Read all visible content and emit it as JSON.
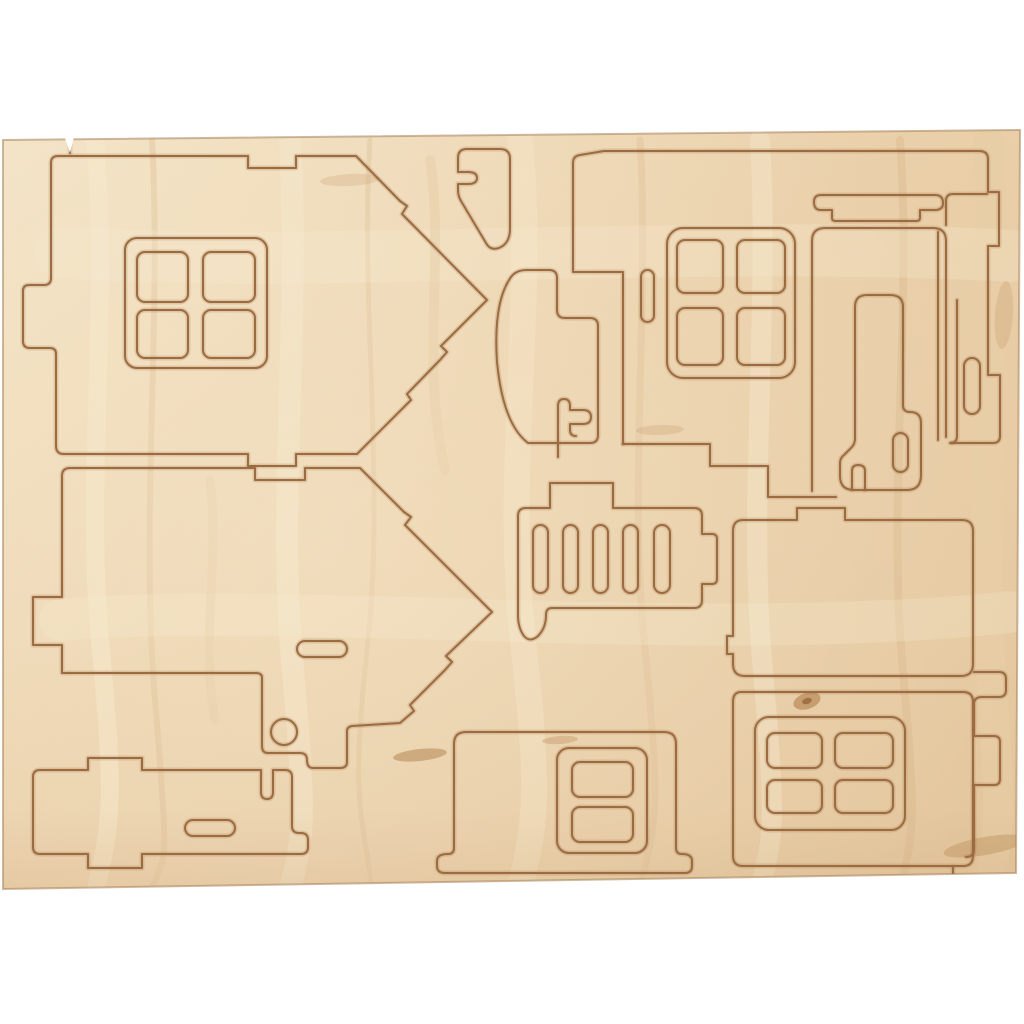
{
  "meta": {
    "description": "Photograph of a light birch plywood sheet with laser-cut press-out pieces for a 3D wooden house kit: two pointed gable walls with a four-pane window, wall panels with four-pane and two-pane windows, a door with frame and lintel, an arch, a chimney, a slotted railing piece and base plates, on a white background"
  },
  "colors": {
    "background": "#ffffff",
    "wood_light": "#f3e3c6",
    "wood_base": "#ead0aa",
    "wood_mid": "#e3c59c",
    "wood_dark": "#d9b88e",
    "grain_light": "#f6e8cc",
    "grain_dark": "#d2ab7e",
    "knot": "#a9773f",
    "cut": "#9c6b40",
    "cut_halo": "rgba(156,107,64,0.22)",
    "sheet_edge": "rgba(168,128,86,0.55)",
    "bottom_shade": "rgba(176,136,94,0.28)"
  },
  "sheet": {
    "outline": "M3,140 L1020,130 L1016,873 L3,889 Z",
    "notches": [
      "M65,138 L74,137 L70,153 Z"
    ]
  },
  "pieces": [
    {
      "name": "gable-wall-upper-left",
      "cuts": [
        {
          "d": "M58,156 H248 V168 H296 V156 H356 L400,201 L407,206 L402,214 L487,300 L441,346 L447,352 L440,360 L407,394 L411,400 L404,407 L357,454 H296 V466 H248 V454 H64 Q56,454 56,446 V354 Q56,348 50,348 H30 Q23,348 23,341 V291 Q23,285 29,285 H44 Q51,285 51,278 V163 Q51,156 58,156 Z"
        },
        {
          "rrect": [
            125,
            238,
            142,
            130,
            12
          ]
        },
        {
          "rrect": [
            137,
            252,
            51,
            50,
            8
          ]
        },
        {
          "rrect": [
            203,
            252,
            52,
            50,
            8
          ]
        },
        {
          "rrect": [
            137,
            310,
            51,
            48,
            8
          ]
        },
        {
          "rrect": [
            203,
            310,
            52,
            48,
            8
          ]
        }
      ]
    },
    {
      "name": "gable-wall-lower-left",
      "cuts": [
        {
          "d": "M70,468 H255 V480 H305 V468 H360 L404,512 L411,517 L405,525 L492,612 L446,656 L452,662 L445,670 L410,705 L414,711 L400,723 L352,726 Q347,727 347,731 V762 Q347,768 340,768 H313 Q307,768 307,760 Q307,753 300,753 H268 Q262,753 262,746 V678 Q262,673 256,673 H62 V645 H33 V597 H62 V476 Q62,468 70,468 Z"
        },
        {
          "rrect": [
            297,
            641,
            50,
            16,
            8
          ]
        },
        {
          "rrect": [
            271,
            719,
            26,
            26,
            13
          ]
        }
      ]
    },
    {
      "name": "base-plate-left",
      "cuts": [
        {
          "d": "M40,770 H88 V758 H142 V770 H261 V792 Q261,799 267,799 Q273,799 273,792 V770 H285 Q292,770 292,777 V826 Q292,833 299,833 H301 Q308,833 308,840 V847 Q308,854 301,854 H142 V868 H88 V854 H40 Q33,854 33,847 V777 Q33,770 40,770 Z"
        },
        {
          "rrect": [
            185,
            820,
            50,
            16,
            8
          ]
        }
      ]
    },
    {
      "name": "chimney-top-center",
      "cuts": [
        {
          "d": "M467,149 Q458,149 458,158 V172 H468 Q477,172 477,178 Q477,184 468,184 H458 V190 Q458,196 461,201 L486,243 Q491,252 501,247 Q510,242 510,229 V159 Q510,149 500,149 Z"
        }
      ]
    },
    {
      "name": "arch-center",
      "cuts": [
        {
          "d": "M527,270 H549 Q557,270 557,278 V310 Q557,318 565,318 H590 Q598,318 598,326 V435 Q598,443 590,443 H528 Q503,424 497,362 Q493,302 511,277 Q516,270 527,270 Z"
        },
        {
          "d": "M558,457 V406 Q558,399 564,399 Q570,399 570,406 V410 H583 Q591,410 591,417 Q591,424 583,424 H570 V430 Q570,436 576,436"
        }
      ]
    },
    {
      "name": "railing-fence-center",
      "cuts": [
        {
          "d": "M526,508 H550 V483 H613 V508 H694 Q702,508 702,516 V534 H712 Q717,534 717,539 V579 Q717,584 712,584 H702 V600 Q702,608 694,608 H552 Q546,608 546,615 Q546,628 538,636 Q530,643 524,636 Q518,628 518,615 V516 Q518,508 526,508 Z"
        },
        {
          "rrect": [
            533,
            525,
            15,
            68,
            7.5
          ]
        },
        {
          "rrect": [
            563,
            525,
            15,
            68,
            7.5
          ]
        },
        {
          "rrect": [
            593,
            525,
            15,
            68,
            7.5
          ]
        },
        {
          "rrect": [
            623,
            525,
            15,
            68,
            7.5
          ]
        },
        {
          "rrect": [
            654,
            525,
            16,
            68,
            8
          ]
        }
      ]
    },
    {
      "name": "front-wall-upper-right",
      "cuts": [
        {
          "d": "M623,444 V272 H573 V163 Q573,156 580,155 L604,151 H979 Q988,151 988,159 V192 H999 V246 H988 V375 H1000 V436 Q1000,443 993,443 H952"
        },
        {
          "d": "M623,444 H710 V466 H768 V497 H836"
        },
        {
          "rrect": [
            667,
            228,
            128,
            150,
            16
          ]
        },
        {
          "rrect": [
            677,
            240,
            46,
            53,
            8
          ]
        },
        {
          "rrect": [
            737,
            240,
            48,
            53,
            8
          ]
        },
        {
          "rrect": [
            677,
            308,
            46,
            57,
            8
          ]
        },
        {
          "rrect": [
            737,
            308,
            48,
            57,
            8
          ]
        },
        {
          "rrect": [
            641,
            270,
            13,
            52,
            6.5
          ]
        }
      ]
    },
    {
      "name": "door-lintel",
      "cuts": [
        {
          "d": "M821,195 H935 Q943,195 943,203 Q943,210 935,210 H920 V218 Q920,221 916,221 H836 Q832,221 832,218 V210 H821 Q814,210 814,202 Q814,195 821,195 Z"
        }
      ]
    },
    {
      "name": "door-and-frame",
      "cuts": [
        {
          "d": "M812,491 V241 Q812,228 825,228 H933 Q946,228 946,241 V437"
        },
        {
          "d": "M867,295 H890 Q903,295 903,307 V405 Q903,412 910,412 Q921,412 921,423 V475 Q921,490 907,490 H854 Q840,490 840,476 V463 Q840,458 844,455 L851,448 Q855,444 855,439 V307 Q855,295 867,295 Z"
        },
        {
          "rrect": [
            893,
            433,
            15,
            39,
            7.5
          ]
        },
        {
          "d": "M852,490 V471 Q852,465 858,465 Q865,465 865,471 V490"
        },
        {
          "d": "M938,232 V440"
        },
        {
          "d": "M957,300 V436 Q957,443 950,443"
        },
        {
          "rrect": [
            964,
            358,
            16,
            56,
            8
          ]
        },
        {
          "d": "M946,225 V201 Q946,194 953,194 H987"
        }
      ]
    },
    {
      "name": "roof-panel-right",
      "cuts": [
        {
          "d": "M743,520 H797 V508 H845 V520 H962 Q973,520 973,531 V664 Q973,676 961,676 H745 Q733,676 733,664 V654 H727 V636 H733 V531 Q733,520 743,520 Z"
        }
      ]
    },
    {
      "name": "side-strip-right",
      "cuts": [
        {
          "d": "M974,672 H999 Q1006,672 1006,679 V690 Q1006,697 999,697 H982 Q974,697 974,704 V736 H994 Q1000,736 1000,742 V779 Q1000,785 994,785 H974 V849 Q974,857 966,857"
        }
      ]
    },
    {
      "name": "window-wall-bottom-center",
      "cuts": [
        {
          "d": "M466,732 Q454,732 454,744 V848 Q454,854 448,854 Q437,854 437,861 V866 Q437,873 445,873 H685 Q692,873 692,866 V861 Q692,854 682,854 Q676,854 676,848 V744 Q676,732 664,732 Z"
        },
        {
          "rrect": [
            557,
            748,
            90,
            105,
            12
          ]
        },
        {
          "rrect": [
            572,
            762,
            61,
            35,
            8
          ]
        },
        {
          "rrect": [
            572,
            807,
            61,
            35,
            8
          ]
        }
      ]
    },
    {
      "name": "window-wall-bottom-right",
      "cuts": [
        {
          "d": "M741,692 H963 Q973,692 973,702 V856 Q973,866 963,866 H743 Q733,866 733,856 V702 Q733,692 741,692 Z"
        },
        {
          "rrect": [
            755,
            717,
            150,
            113,
            14
          ]
        },
        {
          "rrect": [
            767,
            733,
            55,
            35,
            8
          ]
        },
        {
          "rrect": [
            835,
            733,
            58,
            35,
            8
          ]
        },
        {
          "rrect": [
            767,
            780,
            55,
            33,
            8
          ]
        },
        {
          "rrect": [
            835,
            780,
            58,
            33,
            8
          ]
        }
      ]
    },
    {
      "name": "edge-ticks",
      "cuts": [
        {
          "d": "M953,867 V885"
        },
        {
          "d": "M70,141 V153"
        }
      ]
    }
  ],
  "grain": {
    "streaks": [
      {
        "d": "M95,140 C110,300 85,480 100,640 S112,820 96,889",
        "w": 18,
        "c": "#f6e8cc",
        "o": 0.45
      },
      {
        "d": "M152,140 C162,320 140,520 155,700 S165,850 152,889",
        "w": 6,
        "c": "#d2ab7e",
        "o": 0.3
      },
      {
        "d": "M290,140 C300,320 278,500 292,660 S305,830 290,889",
        "w": 22,
        "c": "#f6e8cc",
        "o": 0.4
      },
      {
        "d": "M370,140 C360,300 385,480 368,640 S360,800 372,889",
        "w": 5,
        "c": "#d2ab7e",
        "o": 0.28
      },
      {
        "d": "M520,140 C535,300 505,470 522,630 S538,810 520,889",
        "w": 26,
        "c": "#f6e8cc",
        "o": 0.35
      },
      {
        "d": "M640,140 C650,300 628,480 645,650 S655,820 640,889",
        "w": 7,
        "c": "#d2ab7e",
        "o": 0.25
      },
      {
        "d": "M760,140 C770,300 748,500 762,660 S775,830 760,889",
        "w": 20,
        "c": "#f6e8cc",
        "o": 0.4
      },
      {
        "d": "M900,140 C912,300 888,500 902,660 S915,830 900,889",
        "w": 8,
        "c": "#d2ab7e",
        "o": 0.28
      },
      {
        "d": "M988,140 C998,300 978,500 990,660 S1000,830 988,889",
        "w": 30,
        "c": "#e8cda6",
        "o": 0.5
      },
      {
        "d": "M60,620 C300,600 700,645 1010,612",
        "w": 42,
        "c": "#f6e8cc",
        "o": 0.28
      },
      {
        "d": "M60,252 C300,270 700,238 1010,256",
        "w": 52,
        "c": "#f6e8cc",
        "o": 0.3
      },
      {
        "d": "M430,160 C445,260 420,360 445,470",
        "w": 10,
        "c": "#dfc096",
        "o": 0.35
      },
      {
        "d": "M210,480 C220,560 200,640 215,720",
        "w": 9,
        "c": "#dfc096",
        "o": 0.3
      }
    ],
    "knots": [
      {
        "cx": 807,
        "cy": 701,
        "rx": 14,
        "ry": 8,
        "rot": -18,
        "c": "#a9773f",
        "o": 0.55
      },
      {
        "cx": 807,
        "cy": 701,
        "rx": 5,
        "ry": 3,
        "rot": -18,
        "c": "#8a5a2e",
        "o": 0.65
      },
      {
        "cx": 420,
        "cy": 755,
        "rx": 27,
        "ry": 6,
        "rot": -6,
        "c": "#a9773f",
        "o": 0.45
      },
      {
        "cx": 560,
        "cy": 740,
        "rx": 18,
        "ry": 4,
        "rot": -4,
        "c": "#b98a56",
        "o": 0.35
      },
      {
        "cx": 985,
        "cy": 846,
        "rx": 42,
        "ry": 9,
        "rot": -10,
        "c": "#a9773f",
        "o": 0.3
      },
      {
        "cx": 350,
        "cy": 180,
        "rx": 30,
        "ry": 6,
        "rot": -3,
        "c": "#c79b6a",
        "o": 0.25
      },
      {
        "cx": 1004,
        "cy": 315,
        "rx": 9,
        "ry": 34,
        "rot": 4,
        "c": "#c79b6a",
        "o": 0.3
      },
      {
        "cx": 660,
        "cy": 430,
        "rx": 24,
        "ry": 5,
        "rot": -2,
        "c": "#c79b6a",
        "o": 0.28
      }
    ]
  }
}
